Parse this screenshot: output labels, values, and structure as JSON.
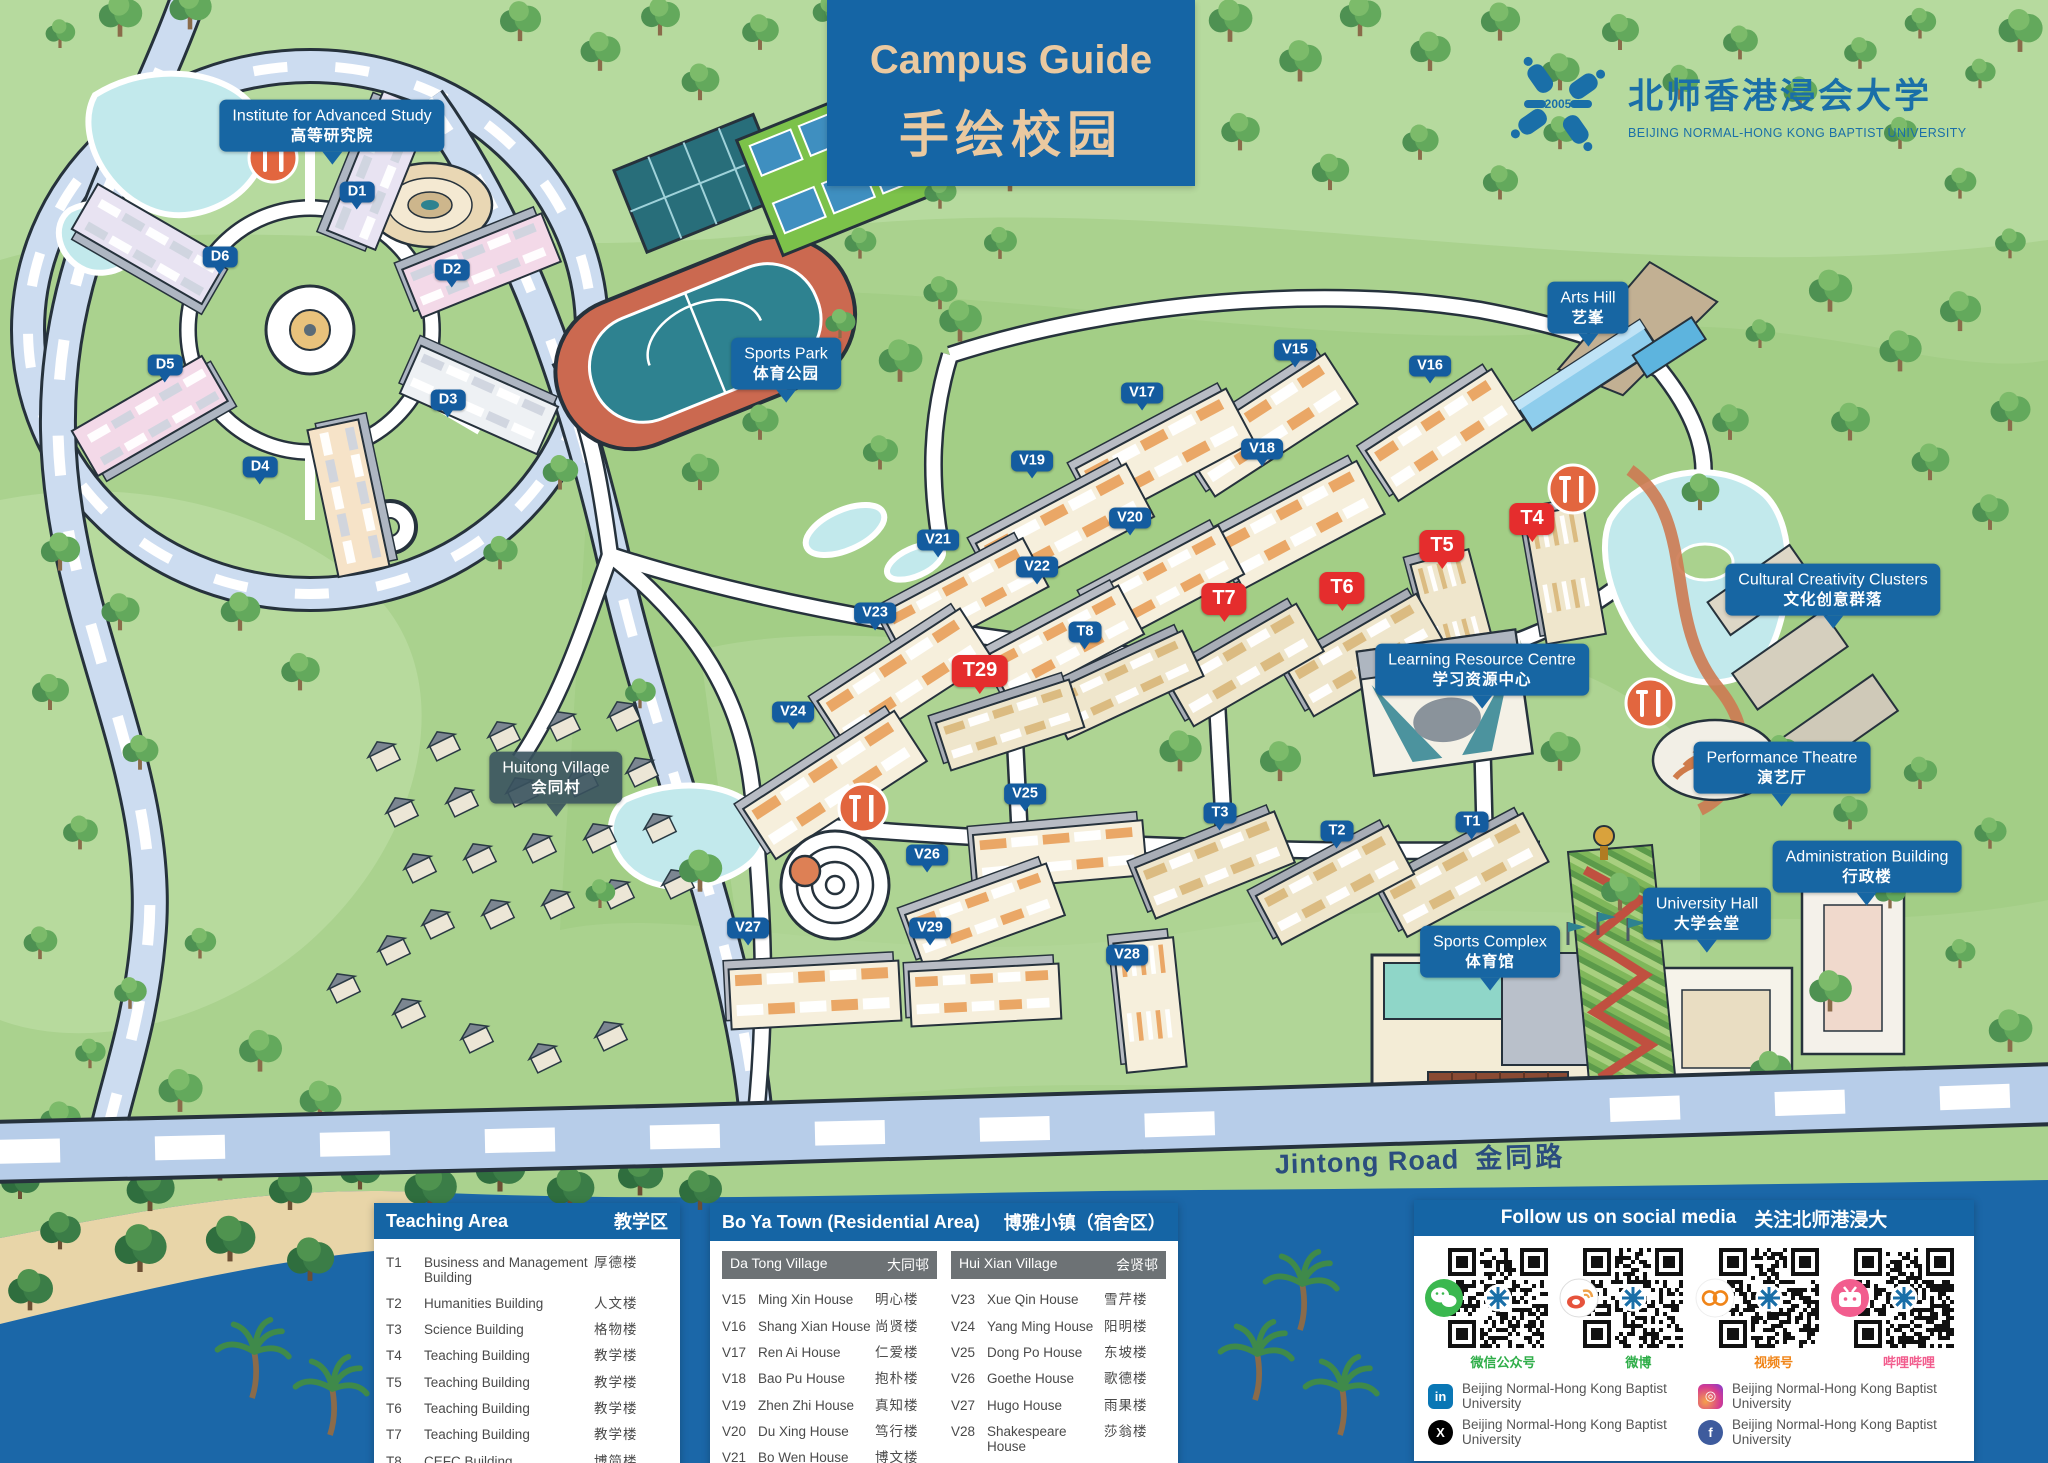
{
  "title": {
    "en": "Campus Guide",
    "zh": "手绘校园"
  },
  "logo": {
    "year": "2005",
    "zh": "北师香港浸会大学",
    "en": "BEIJING NORMAL-HONG KONG BAPTIST UNIVERSITY"
  },
  "map": {
    "road": {
      "en": "Jintong Road",
      "zh": "金同路"
    },
    "tags": [
      {
        "id": "institute-for-advanced-study",
        "en": "Institute for Advanced Study",
        "zh": "高等研究院",
        "x": 332,
        "y": 166
      },
      {
        "id": "sports-park",
        "en": "Sports Park",
        "zh": "体育公园",
        "x": 786,
        "y": 404
      },
      {
        "id": "arts-hill",
        "en": "Arts Hill",
        "zh": "艺峯",
        "x": 1588,
        "y": 348
      },
      {
        "id": "learning-resource-centre",
        "en": "Learning Resource Centre",
        "zh": "学习资源中心",
        "x": 1482,
        "y": 710
      },
      {
        "id": "cultural-creativity-clusters",
        "en": "Cultural Creativity Clusters",
        "zh": "文化创意群落",
        "x": 1833,
        "y": 630
      },
      {
        "id": "performance-theatre",
        "en": "Performance Theatre",
        "zh": "演艺厅",
        "x": 1782,
        "y": 808
      },
      {
        "id": "administration-building",
        "en": "Administration Building",
        "zh": "行政楼",
        "x": 1867,
        "y": 907
      },
      {
        "id": "university-hall",
        "en": "University Hall",
        "zh": "大学会堂",
        "x": 1707,
        "y": 954
      },
      {
        "id": "sports-complex",
        "en": "Sports Complex",
        "zh": "体育馆",
        "x": 1490,
        "y": 992
      },
      {
        "id": "huitong-village",
        "en": "Huitong Village",
        "zh": "会同村",
        "x": 556,
        "y": 818,
        "variant": "dark"
      }
    ],
    "badges": [
      {
        "t": "D1",
        "x": 357,
        "y": 192,
        "c": "blue"
      },
      {
        "t": "D2",
        "x": 452,
        "y": 270,
        "c": "blue"
      },
      {
        "t": "D3",
        "x": 448,
        "y": 400,
        "c": "blue"
      },
      {
        "t": "D4",
        "x": 260,
        "y": 467,
        "c": "blue"
      },
      {
        "t": "D5",
        "x": 165,
        "y": 365,
        "c": "blue"
      },
      {
        "t": "D6",
        "x": 220,
        "y": 257,
        "c": "blue"
      },
      {
        "t": "V15",
        "x": 1295,
        "y": 350,
        "c": "blue"
      },
      {
        "t": "V16",
        "x": 1430,
        "y": 366,
        "c": "blue"
      },
      {
        "t": "V17",
        "x": 1142,
        "y": 393,
        "c": "blue"
      },
      {
        "t": "V18",
        "x": 1262,
        "y": 449,
        "c": "blue"
      },
      {
        "t": "V19",
        "x": 1032,
        "y": 461,
        "c": "blue"
      },
      {
        "t": "V20",
        "x": 1130,
        "y": 518,
        "c": "blue"
      },
      {
        "t": "V21",
        "x": 938,
        "y": 540,
        "c": "blue"
      },
      {
        "t": "V22",
        "x": 1037,
        "y": 567,
        "c": "blue"
      },
      {
        "t": "V23",
        "x": 875,
        "y": 613,
        "c": "blue"
      },
      {
        "t": "V24",
        "x": 793,
        "y": 712,
        "c": "blue"
      },
      {
        "t": "V25",
        "x": 1025,
        "y": 794,
        "c": "blue"
      },
      {
        "t": "V26",
        "x": 927,
        "y": 855,
        "c": "blue"
      },
      {
        "t": "V27",
        "x": 748,
        "y": 928,
        "c": "blue"
      },
      {
        "t": "V28",
        "x": 1127,
        "y": 955,
        "c": "blue"
      },
      {
        "t": "V29",
        "x": 930,
        "y": 928,
        "c": "blue"
      },
      {
        "t": "T1",
        "x": 1472,
        "y": 822,
        "c": "blue"
      },
      {
        "t": "T2",
        "x": 1337,
        "y": 831,
        "c": "blue"
      },
      {
        "t": "T3",
        "x": 1220,
        "y": 813,
        "c": "blue"
      },
      {
        "t": "T8",
        "x": 1085,
        "y": 632,
        "c": "blue"
      },
      {
        "t": "T4",
        "x": 1532,
        "y": 519,
        "c": "red"
      },
      {
        "t": "T5",
        "x": 1442,
        "y": 546,
        "c": "red"
      },
      {
        "t": "T6",
        "x": 1342,
        "y": 588,
        "c": "red"
      },
      {
        "t": "T7",
        "x": 1224,
        "y": 599,
        "c": "red"
      },
      {
        "t": "T29",
        "x": 980,
        "y": 671,
        "c": "red"
      }
    ],
    "pois": [
      {
        "name": "restaurant-icon",
        "x": 273,
        "y": 158
      },
      {
        "name": "restaurant-icon",
        "x": 1573,
        "y": 489
      },
      {
        "name": "restaurant-icon",
        "x": 1650,
        "y": 703
      },
      {
        "name": "restaurant-icon",
        "x": 863,
        "y": 808
      }
    ]
  },
  "legend": {
    "teaching": {
      "title_en": "Teaching Area",
      "title_zh": "教学区",
      "rows": [
        {
          "code": "T1",
          "en": "Business and Management Building",
          "zh": "厚德楼"
        },
        {
          "code": "T2",
          "en": "Humanities Building",
          "zh": "人文楼"
        },
        {
          "code": "T3",
          "en": "Science Building",
          "zh": "格物楼"
        },
        {
          "code": "T4",
          "en": "Teaching Building",
          "zh": "教学楼"
        },
        {
          "code": "T5",
          "en": "Teaching Building",
          "zh": "教学楼"
        },
        {
          "code": "T6",
          "en": "Teaching Building",
          "zh": "教学楼"
        },
        {
          "code": "T7",
          "en": "Teaching Building",
          "zh": "教学楼"
        },
        {
          "code": "T8",
          "en": "CEFC Building",
          "zh": "博简楼"
        },
        {
          "code": "T29",
          "en": "Teaching Building",
          "zh": "教学楼"
        }
      ]
    },
    "boya": {
      "title_en": "Bo Ya Town (Residential Area)",
      "title_zh": "博雅小镇（宿舍区）",
      "villages": [
        {
          "name_en": "Da Tong Village",
          "name_zh": "大同邨",
          "rows": [
            {
              "code": "V15",
              "en": "Ming Xin House",
              "zh": "明心楼"
            },
            {
              "code": "V16",
              "en": "Shang Xian House",
              "zh": "尚贤楼"
            },
            {
              "code": "V17",
              "en": "Ren Ai House",
              "zh": "仁爱楼"
            },
            {
              "code": "V18",
              "en": "Bao Pu House",
              "zh": "抱朴楼"
            },
            {
              "code": "V19",
              "en": "Zhen Zhi House",
              "zh": "真知楼"
            },
            {
              "code": "V20",
              "en": "Du Xing House",
              "zh": "笃行楼"
            },
            {
              "code": "V21",
              "en": "Bo Wen House",
              "zh": "博文楼"
            },
            {
              "code": "V22",
              "en": "Ya Zhi House",
              "zh": "雅志楼"
            }
          ]
        },
        {
          "name_en": "Hui Xian Village",
          "name_zh": "会贤邨",
          "rows": [
            {
              "code": "V23",
              "en": "Xue Qin House",
              "zh": "雪芹楼"
            },
            {
              "code": "V24",
              "en": "Yang Ming House",
              "zh": "阳明楼"
            },
            {
              "code": "V25",
              "en": "Dong Po House",
              "zh": "东坡楼"
            },
            {
              "code": "V26",
              "en": "Goethe House",
              "zh": "歌德楼"
            },
            {
              "code": "V27",
              "en": "Hugo House",
              "zh": "雨果楼"
            },
            {
              "code": "V28",
              "en": "Shakespeare House",
              "zh": "莎翁楼"
            },
            {
              "code": "V29",
              "en": "Yung Wing House",
              "zh": "容闳楼"
            }
          ]
        }
      ]
    },
    "social": {
      "title_en": "Follow us on social media",
      "title_zh": "关注北师港浸大",
      "qr": [
        {
          "platform": "wechat",
          "icon": "wechat-icon",
          "label": "微信公众号",
          "label_color": "#2fae49"
        },
        {
          "platform": "weibo",
          "icon": "weibo-icon",
          "label": "微博",
          "label_color": "#2fae49"
        },
        {
          "platform": "wechat-channels",
          "icon": "wechat-channels-icon",
          "label": "视频号",
          "label_color": "#f08519"
        },
        {
          "platform": "bilibili",
          "icon": "bilibili-icon",
          "label": "哔哩哔哩",
          "label_color": "#f25d8e"
        }
      ],
      "accounts": [
        {
          "platform": "linkedin",
          "icon": "linkedin-icon",
          "glyph": "in",
          "color": "#0a77b5",
          "shape": "sq",
          "name": "Beijing Normal-Hong Kong Baptist University"
        },
        {
          "platform": "instagram",
          "icon": "instagram-icon",
          "glyph": "◎",
          "color": "#d63b8f",
          "shape": "sq",
          "name": "Beijing Normal-Hong Kong Baptist University"
        },
        {
          "platform": "x",
          "icon": "x-icon",
          "glyph": "X",
          "color": "#000000",
          "shape": "rd",
          "name": "Beijing Normal-Hong Kong Baptist University"
        },
        {
          "platform": "facebook",
          "icon": "facebook-icon",
          "glyph": "f",
          "color": "#3e5b9d",
          "shape": "rd",
          "name": "Beijing Normal-Hong Kong Baptist University"
        }
      ]
    }
  }
}
